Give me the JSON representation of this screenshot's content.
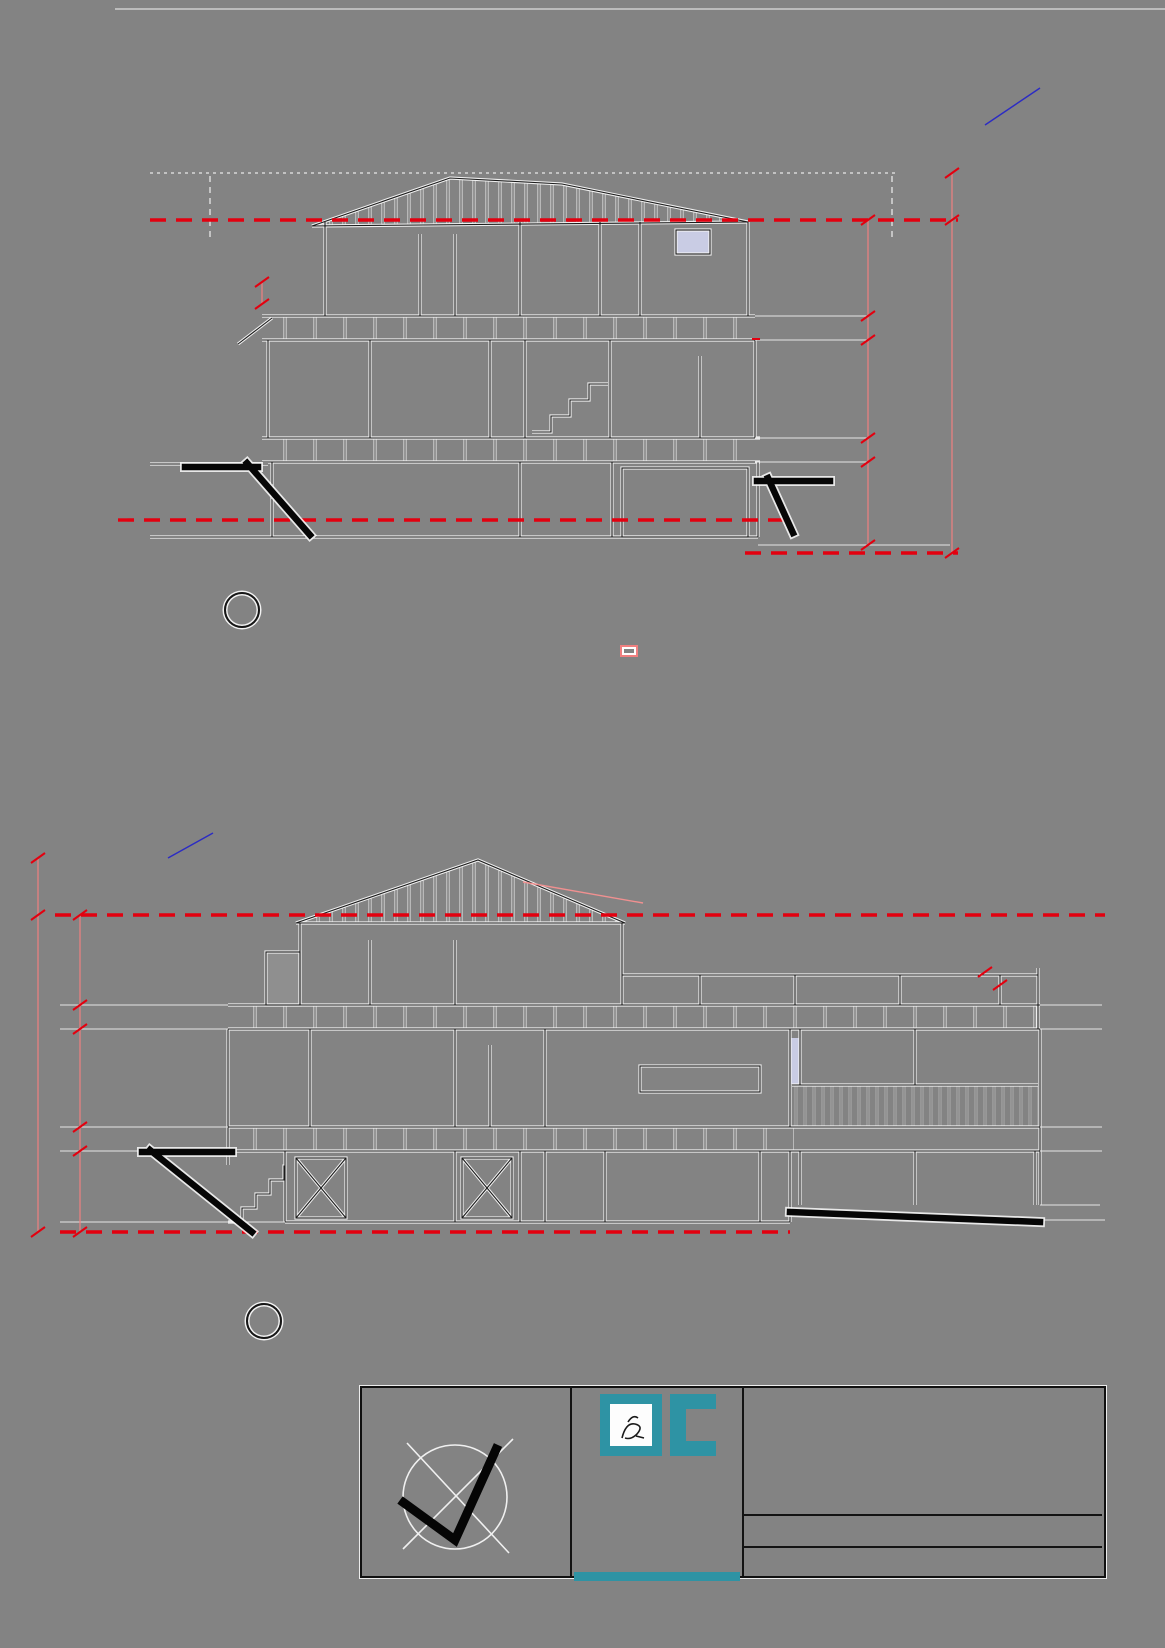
{
  "notes": {
    "cloud_extent": "RED CLOUD INDICATES EXTENT OF PROPOSED\nMODIFICATION TO APPROVED DA.",
    "levels_corrected": "EXISTING FINISHED FLOOR LEVELS CORRECTED\nAND A LEVELLING PLATE IS PROPOSED TO BE\nUSED, LIFTING THE OVERALL BUILDING HEIGHT\n155mm FROM 9.964m TO 10.119m",
    "red_line": "RED LINE INDICATES 8.5m\nABOVE EXISTING GROUND LEVEL",
    "levelling_plate": "150mm LEVELLING PLATE ATOP\nFLOOR JOISTS",
    "position_ground": "POSITION OF EXISTING GROUND\nLEVEL (UNDERNEATH THE\nEXISTING BASEMENT SLAB)",
    "agricultural_drain": "AGRICULTURAL\nDRAIN",
    "concrete1": "REINFORCED CONCRETE FLOOR AND FOOTINGS TO\nENGINEERS FUTURE DETAILS WITH WATERPROOFING MEMBRANE UNDER",
    "concrete2": "0.2 MICRON HIGH IMPACT MEMBRANE AS PER THE REQUIREMENTS\nOF CLAUSE 3.2.2.6 (NSW VARIATION) OF VOLUME 2 OF THE NCCS - BCA",
    "bal": "PROPOSED ADDITIONS AND\nALTERATIONS TO DWELLING HOUSE\nIS TO COMPLY WITH AS 3959-2009\nFOR BAL 12.5 CONSTRUCTION",
    "roof_area": "ROOF AREA THAT CONTRAVENES\nTHE HORNSBY LEP DEVELOPMENT\nSTANDARD, FOR WHICH WE\nREQUEST A CLAUSE 4.6 VARIATION\nPLEASE",
    "da2": "DA CONSENT CONDITION 2 - NO CLEARING OF VEGETATION\nNO VEGETATION IS TO BE CLEARED PRIOR TO ISSUE OF A CONSTRUCTION\nCERTIFICATE.",
    "da3": "DA CONSENT CONDITION 3 - AMENDMENT OF PLANS\n1. TO COMPLY WITH COUNCILS REQUIREMENT IN TERMS OF PRIVACY,\nTHE ALFRESCO AS INDICATED IN RED ON THE APPROVED PLANS MUST\nHAVE PRIVACY SCREENING AS FOLLOWS:\nA. A 1.5 METRE HIGH PRIVACY SCREEN MUST BE ERECTED ALONG THOSE\nPARTS OF THE EASTERN AND WESTERN ELEVATIONS OF THE DECK\nLOCATED LESS THAN 3M FROM THE SIDE BOUNDARY TO MINIMISE A\nDIRECT LINE OF SIGHT TO THE ADJACENT PROPERTIES, KNOWN AS NO. 29\nAND 33 BOUNDARY ROAD.\nB. THE SCREEN MUST HAVE NO INDIVIDUAL OPENINGS MORE THAN 30MM",
    "da10": "DA CONSENT CONDITION 10 - DESIGN AND CONSTRUCTION - BUSHFIRE\nATTACK CATEGORY\nNEW CONSTRUCTION MUST COMPLY WITH THE CURRENT AUSTRALIAN\nSTANDARD AS3959 'CONSTRUCTION OF BUILDINGS IN BUSH FIRE-PRONE\nAREAS' SECTION 3 AND 5 (BAL 12.5) AND PLANNING FOR BUSHFIRE\nPROTECTION 2019"
  },
  "rl": [
    "RL 78.045",
    "RL 75.645",
    "RL 75.195",
    "RL 72.395",
    "RL 72.095",
    "RL 69.98"
  ],
  "dims": {
    "d1619": "1619",
    "d2400": "2400",
    "d450": "450",
    "d2800": "2800",
    "d300": "300",
    "d2115": "2115",
    "d8500": "8500"
  },
  "section1": {
    "number": "2",
    "title": "Section 1",
    "scale": "1 : 100",
    "ridge": "RIDGE RL 79.259",
    "boundary": "BOUNDARY",
    "rooms": {
      "ensuite": "ENSUITE",
      "stair": "STAIR",
      "bedroom_four": "BEDROOM\nFOUR",
      "bedroom_three": "BEDROOM\nTHREE",
      "bath": "BATH",
      "office_guest": "OFFICE\nGUEST\nBEDROOM",
      "subfloor": "SUB FLOOR\nBASEMENT STORAGE",
      "garage": "GARAGE"
    }
  },
  "section2": {
    "number": "1",
    "title": "Section 2",
    "scale": "1 : 100",
    "rooms": {
      "master": "MASTER\nBEDROOM",
      "entry": "ENTRY",
      "meals": "MEALS/FAMILY\nROOM",
      "alfresco": "ALFRESCO",
      "store": "STORE/GARAGE",
      "office": "OFFICE"
    }
  },
  "title_block": {
    "north": "NORTH",
    "compliance": "ARCHITECTURAL PLANS TO BE IN ACCORDANCE WITH\nNCC 2022 VOLUME 2 BUILDING CODE OF AUSTRALIA\n2022 & HOUSING PROVISIONS STANDARD 2022",
    "company": "Russell Scott Designs",
    "address": "2A Crane Road, Castle Hill NSW 2154",
    "phone1": "Russell: 0411 108 573",
    "email1": "russcott@bigpond.com",
    "phone2": "Sophie: 0412 067 183",
    "email2": "sophieannscott@gmail.com",
    "project": "Proposed Additions and Alterations to\nExisting Dwelling at: -",
    "lot": "Lot 7 DP 30286",
    "street": "31 Boundary Road",
    "suburb": "North Epping NSW 2121",
    "client": "For Mr & Mrs G. Harding",
    "date": "10th September 2025"
  }
}
